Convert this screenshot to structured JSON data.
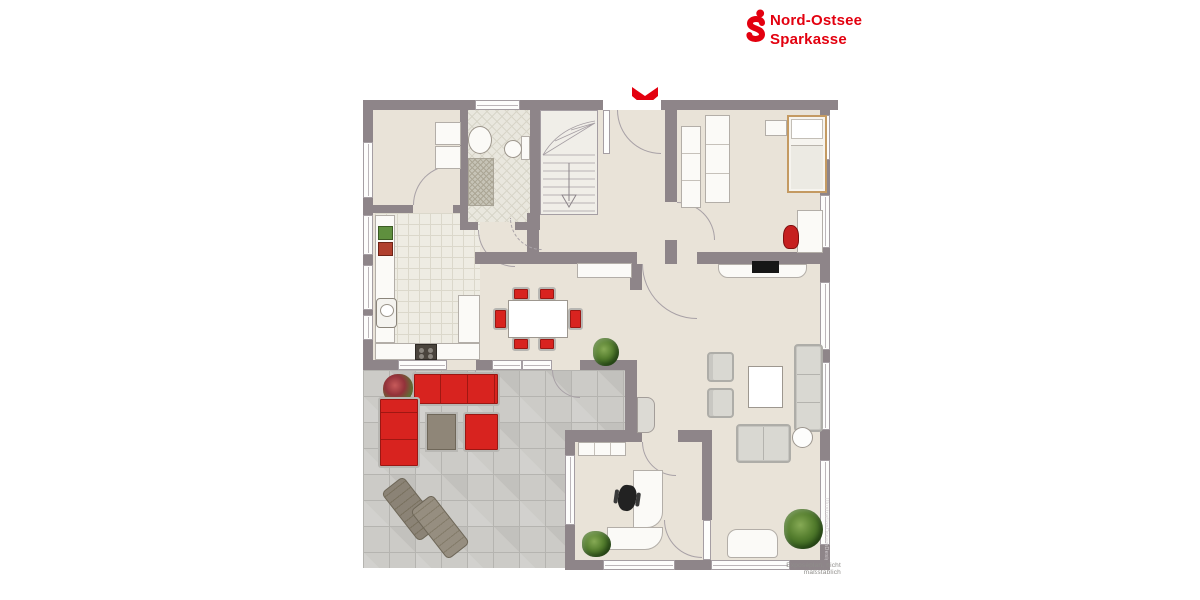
{
  "brand": {
    "logo_icon": "sparkasse-s-icon",
    "name_line1": "Nord-Ostsee",
    "name_line2": "Sparkasse",
    "brand_color": "#e3000f"
  },
  "floorplan": {
    "entrance_marker_icon": "entrance-arrow-icon",
    "disclaimer": "Exposéplan, nicht maßstäblich",
    "watermark": "IllustrationDreamDesign",
    "palette": {
      "wall": "#8e8589",
      "interior_floor": "#e9e3d8",
      "terrace_floor": "#cccbc7",
      "accent_red": "#d8231f",
      "light_furniture": "#fbfaf7",
      "wood": "#c49a62"
    }
  }
}
